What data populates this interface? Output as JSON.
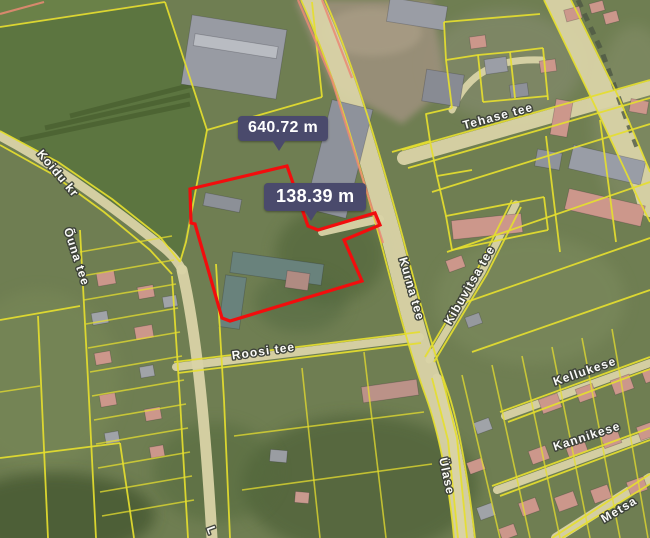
{
  "measurements": {
    "total": "640.72 m",
    "segment": "138.39 m"
  },
  "streets": {
    "koidu_kr": "Koidu kr",
    "ouna_tee": "Õuna tee",
    "tehase_tee": "Tehase tee",
    "kurna_tee": "Kurna tee",
    "kibuvitsa_tee": "Kibuvitsa tee",
    "roosi_tee": "Roosi tee",
    "kellukese": "Kellukese",
    "kannikese": "Kannikese",
    "ulase": "Ülase",
    "metsa": "Metsa",
    "partial_label": "L"
  },
  "colors": {
    "cadastral_line": "#e5de2f",
    "measure_outline": "#f20d0d",
    "measure_label_bg": "#4a4a6c",
    "measure_label_text": "#ffffff",
    "road_fill": "#d9d3a6",
    "road_accent": "#ea8a74",
    "street_label_text": "#ffffff"
  }
}
